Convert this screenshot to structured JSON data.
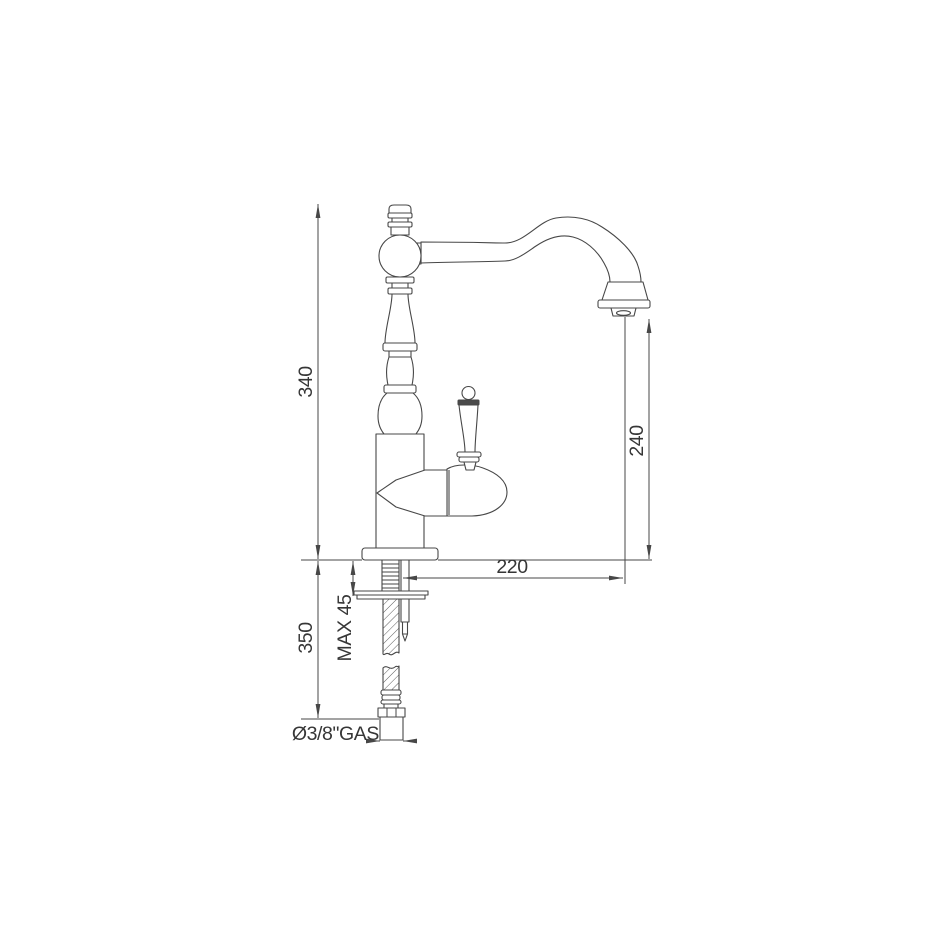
{
  "drawing": {
    "title": "kitchen-faucet-technical-drawing",
    "dimensions": {
      "total_height": "340",
      "spout_outlet_height": "240",
      "spout_reach": "220",
      "under_counter_length": "350",
      "max_counter_thickness": "MAX 45",
      "connection_size": "Ø3/8\"GAS"
    },
    "colors": {
      "line": "#474747",
      "text": "#363636",
      "background": "#ffffff"
    }
  }
}
